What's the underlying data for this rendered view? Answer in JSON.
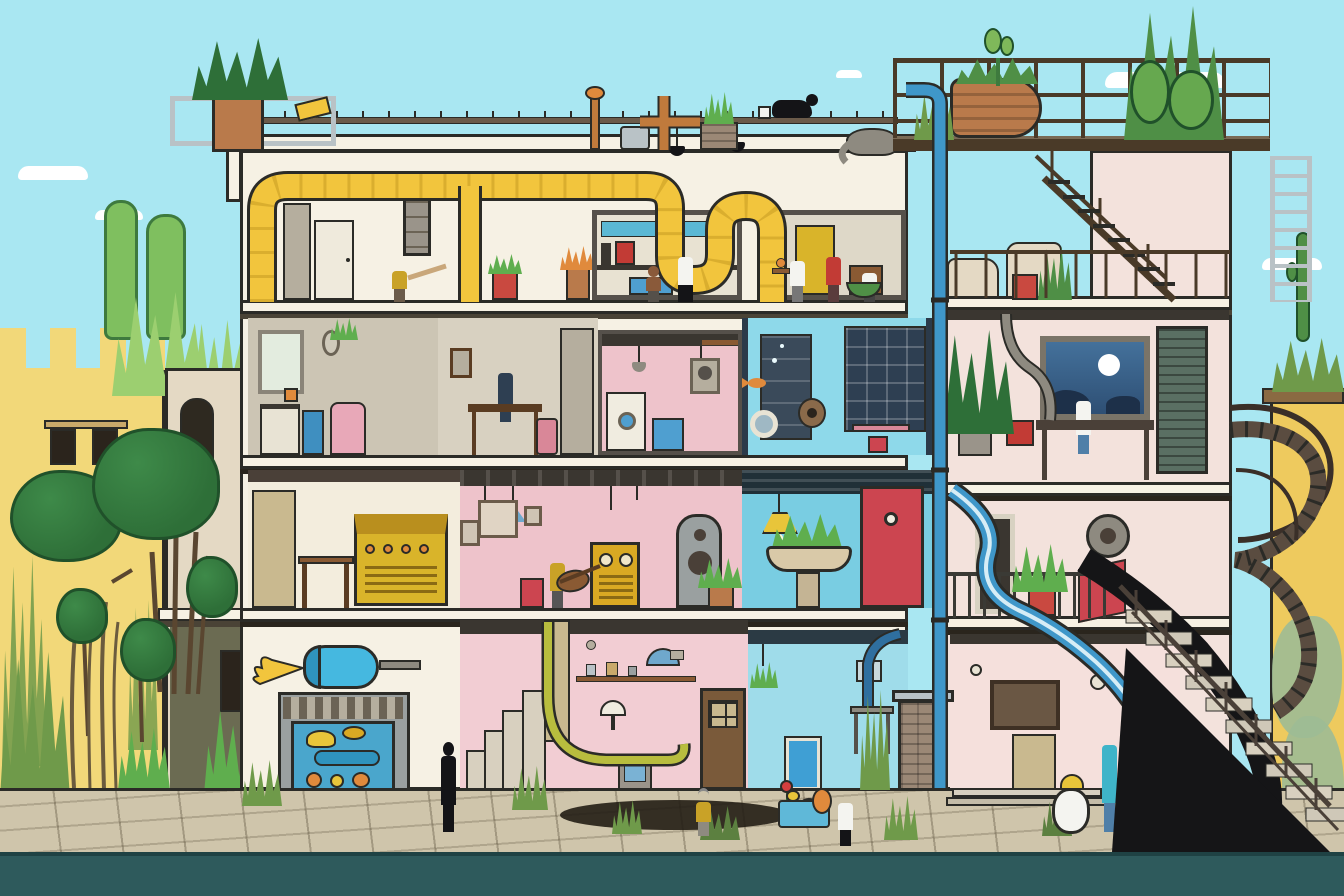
{
  "image": {
    "width": 1344,
    "height": 896,
    "kind": "digital illustration",
    "visible_text": "none"
  },
  "palette": {
    "sky": "#a9e7f2",
    "cloud": "#ffffff",
    "footer": "#2e5a5c",
    "pave": "#cfc5ab",
    "pave-dark": "#9a9076",
    "shadow": "#221d14",
    "line": "#2b2b27",
    "wall-white": "#f6f1e4",
    "wall-cream": "#f3eddd",
    "wall-pinkwhite": "#f3e2dc",
    "pier-shadow": "#d8d2c2",
    "room-grey": "#ccc5b4",
    "room-grey2": "#d8d1c1",
    "room-pink": "#eec3cb",
    "room-pink2": "#f2cdd3",
    "room-pink3": "#f5e0dc",
    "room-cyan": "#8ed9ea",
    "room-cyan2": "#79cde2",
    "room-cyan3": "#9fdcea",
    "navy": "#2e3f52",
    "navy2": "#3a4a5a",
    "window-day": "#e3ecdf",
    "window-night": "#44719b",
    "moon": "#ffffff",
    "duct": "#f2c53d",
    "duct-dark": "#c79a23",
    "copper": "#c07a3c",
    "metal": "#8e8a80",
    "metal-light": "#b9c2c6",
    "steel": "#6b5b4a",
    "wood": "#8a5a33",
    "wood-dark": "#5a3c22",
    "pipe-blue": "#3f97c9",
    "pipe-navy": "#2f6f9f",
    "tank": "#45b8e0",
    "red": "#c23b35",
    "red2": "#cc4550",
    "planter": "#c94940",
    "pink-f": "#e8a8b8",
    "pink-desk": "#d98798",
    "yellow-bldg": "#eeca5e",
    "yellow-bldg2": "#f2d879",
    "sand": "#e4d9c4",
    "olive": "#6b6b52",
    "tree": "#2e6f38",
    "tree-dark": "#20512a",
    "leaf": "#5fae4e",
    "aloe": "#9ccf70",
    "cactus": "#4f8f46",
    "grass": "#6f9a4a",
    "hose": "#b8bd3e",
    "mural-green": "#9dbb95",
    "brick": "#9b8876",
    "terracotta": "#b97a4b",
    "mustard": "#c9a227",
    "denim": "#4f7fa8",
    "turquoise": "#3fb4c9",
    "skin": "#caa27e",
    "skin-dark": "#8a5a3a",
    "hair": "#1a1a1a",
    "white": "#f4f4f0",
    "black": "#141417",
    "orange": "#e08a3c",
    "blue-door": "#3f9fd4",
    "lamp-blue": "#6fa8cc",
    "bench": "#5fb8d8"
  },
  "scene": {
    "description": "Daytime cutaway illustration of a four-storey apartment building sliced open to reveal its rooms, flanked by a yellow crenellated house with broccoli-shaped trees on the left, a rooftop cactus terrace and external fire-escape, spiral and stone staircases on the right, blue water pipes threading through the floors, and a teal street strip across the foreground.",
    "sky": {
      "color_key": "sky",
      "clouds": 5
    },
    "street": {
      "pavement_color_key": "pave",
      "foreground_strip_color_key": "footer",
      "details": [
        "cracked flagstones",
        "dark pothole shadow",
        "weed tufts",
        "tiny red flower",
        "entry steps"
      ]
    },
    "left_neighborhood": {
      "castle_house": {
        "color_key": "yellow-bldg2",
        "features": [
          "crenellated parapet",
          "two dark windows with lintel",
          "climbing vines",
          "tall grass at base"
        ]
      },
      "tower_house": {
        "color_key": "sand",
        "features": [
          "arched dark doorway",
          "white balcony slab",
          "olive lower wall",
          "small service door"
        ]
      },
      "vegetation": [
        "two pale-green column trees",
        "agave clumps on parapet",
        "five broccoli-crown trees",
        "thin saplings",
        "fern and leafy shrub"
      ]
    },
    "main_building": {
      "facade_color_key": "wall-white",
      "right_wing_color_key": "wall-pinkwhite",
      "roof": {
        "items": [
          "terracotta planter with palm fronds",
          "steel frame stand",
          "guard rail with ticks",
          "yellow clamp",
          "copper crab valve",
          "grey utility box",
          "copper T-pipe",
          "brick planter with sprigs",
          "black cat beside white mug",
          "grey elephant ornament"
        ]
      },
      "rooftop_terrace": {
        "railing": "rusty three-rail steel balustrade",
        "deck": "dark timber slab",
        "plants": [
          "tall columnar cacti",
          "paddle cactus",
          "ornate orange urn with succulents",
          "red planter box",
          "snake plant"
        ],
        "access": [
          "steel fire-escape flight with landing",
          "wall ladder"
        ]
      },
      "floors": [
        {
          "name": "top floor",
          "wall_color_key": "wall-cream",
          "rooms": [
            {
              "name": "duct room",
              "items": [
                "large yellow ventilation duct",
                "grey locker",
                "white door",
                "wall cabinet frame",
                "dome lamp"
              ]
            },
            {
              "name": "kitchen nook",
              "items": [
                "cyan tile strip",
                "red coffee machine",
                "blue cabinet",
                "dark counter",
                "red planter",
                "flower pot"
              ]
            },
            {
              "name": "pantry nook",
              "items": [
                "yellow cupboard",
                "open shelves",
                "wooden stool",
                "black pendant lamps"
              ]
            }
          ]
        },
        {
          "name": "second floor",
          "rooms": [
            {
              "name": "grey studio",
              "wall_color_key": "room-grey",
              "items": [
                "bright window",
                "oval portrait",
                "hanging plant",
                "white sink unit",
                "blue bin",
                "pink armchair",
                "orange crate"
              ]
            },
            {
              "name": "workroom",
              "wall_color_key": "room-grey2",
              "items": [
                "wooden desk",
                "pink suitcase",
                "tall grey door",
                "wall frame"
              ]
            },
            {
              "name": "laundry nook",
              "wall_color_key": "room-pink",
              "items": [
                "white washing machine",
                "blue crate",
                "wall washer frame",
                "pendant cones",
                "shelf"
              ]
            },
            {
              "name": "aquarium room",
              "wall_color_key": "room-cyan",
              "items": [
                "navy shelving cabinets",
                "swimming goldfish",
                "white porthole",
                "round speaker",
                "pink desk with red stool",
                "air bubbles"
              ]
            },
            {
              "name": "night office",
              "wall_color_key": "wall-pinkwhite",
              "items": [
                "big blue window with full moon",
                "dark desk",
                "red machine",
                "potted palm",
                "louvred shutter",
                "S-shaped grey pipe"
              ]
            }
          ]
        },
        {
          "name": "third floor",
          "rooms": [
            {
              "name": "workshop",
              "wall_color_key": "wall-cream",
              "items": [
                "storage shelf",
                "wooden bench",
                "yellow amp cabinet with orange dials"
              ]
            },
            {
              "name": "music room",
              "wall_color_key": "room-pink",
              "items": [
                "joist ceiling with hanging tools",
                "blue cone lamp",
                "picture frames",
                "yellow radio cabinet",
                "tall arched speaker",
                "potted plant",
                "red stool",
                "acoustic guitar"
              ]
            },
            {
              "name": "bathroom",
              "wall_color_key": "room-cyan2",
              "items": [
                "dark service ceiling",
                "yellow pendant lamp",
                "stone basin with plant",
                "red door with porthole"
              ]
            },
            {
              "name": "balcony nook",
              "wall_color_key": "wall-pinkwhite",
              "items": [
                "iron balcony rail",
                "red planter",
                "dark doorway",
                "steel drum machine",
                "red chute mouth",
                "blue slide pipe",
                "black chute"
              ]
            }
          ]
        },
        {
          "name": "ground floor",
          "rooms": [
            {
              "name": "pink cellar",
              "wall_color_key": "room-pink2",
              "items": [
                "stepped staircase",
                "ladder shelf",
                "wall shelf with jars",
                "blue ceiling lamp",
                "mushroom lamp",
                "green garden hose",
                "brown door with panes",
                "cabinet with blue panel"
              ]
            },
            {
              "name": "blue wash room",
              "wall_color_key": "room-cyan3",
              "items": [
                "bright blue door",
                "hanging plant",
                "grey side table",
                "navy drain pipe",
                "small poster"
              ]
            },
            {
              "name": "street room",
              "wall_color_key": "room-pink3",
              "items": [
                "framed dark artwork",
                "wooden shelf unit",
                "wall gauges",
                "entry steps"
              ]
            }
          ]
        }
      ],
      "infrastructure": [
        "blue standpipe from roof to street",
        "blue water-slide pipe",
        "black chute",
        "brick chimney stump",
        "horizontal blue water tank with yellow hook",
        "mosaic-framed aquarium mural with goldfish and ducks",
        "spiral staircase",
        "stone outdoor staircase with iron railing"
      ]
    },
    "right_house": {
      "color_key": "yellow-bldg",
      "features": [
        "brown parapet cap",
        "rooftop grass and thin cactus",
        "sage-green mural blobs on lower wall"
      ]
    },
    "characters": [
      {
        "name": "batter",
        "where": "top floor left",
        "look": "yellow apron, swinging a stick"
      },
      {
        "name": "cook-woman",
        "where": "kitchen nook",
        "look": "white top, black skirt"
      },
      {
        "name": "child-helper",
        "where": "kitchen nook",
        "look": "dark hair, tan shirt"
      },
      {
        "name": "chef",
        "where": "top floor right",
        "look": "white coat, carrying orange dish"
      },
      {
        "name": "woman-in-red",
        "where": "top floor right",
        "look": "red dress with tray"
      },
      {
        "name": "greens-carrier",
        "where": "top floor right",
        "look": "white shirt, green basket"
      },
      {
        "name": "desk-worker",
        "where": "second-floor workroom",
        "look": "navy outfit, seated at desk"
      },
      {
        "name": "guitarist",
        "where": "music room",
        "look": "mustard vest, long black hair"
      },
      {
        "name": "night-worker",
        "where": "night office",
        "look": "white tee, jeans"
      },
      {
        "name": "silhouette-passerby",
        "where": "street left of cellar",
        "look": "all-black silhouette"
      },
      {
        "name": "elder-resident",
        "where": "by cellar door",
        "look": "mustard shirt, grey trousers"
      },
      {
        "name": "child",
        "where": "street by blue room",
        "look": "white tee, black shorts"
      },
      {
        "name": "woman-turquoise",
        "where": "street room",
        "look": "turquoise jacket, jeans"
      },
      {
        "name": "round-robot",
        "where": "street room",
        "look": "white round body, yellow cap"
      },
      {
        "name": "orange-figure",
        "where": "street bench",
        "look": "small orange creature"
      }
    ]
  }
}
